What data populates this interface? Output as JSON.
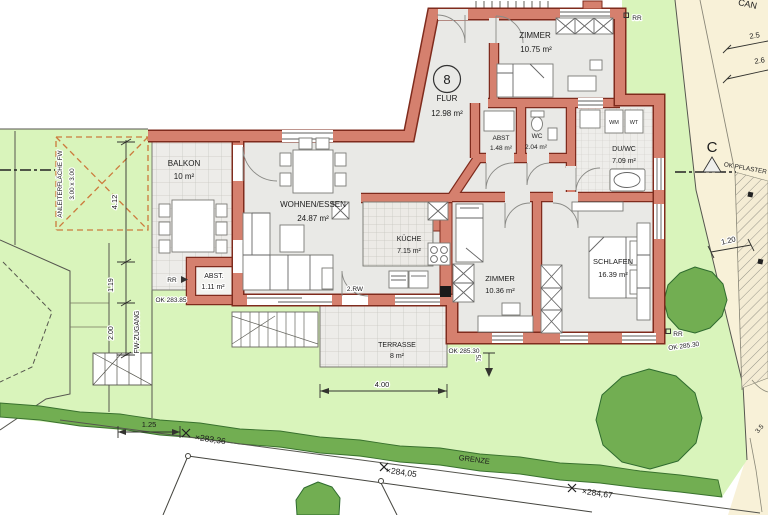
{
  "plan": {
    "apartment_number": "8",
    "rooms": {
      "balkon": {
        "name": "BALKON",
        "area": "10 m²"
      },
      "wohnen": {
        "name": "WOHNEN/ESSEN",
        "area": "24.87 m²"
      },
      "flur": {
        "name": "FLUR",
        "area": "12.98 m²"
      },
      "zimmer1": {
        "name": "ZIMMER",
        "area": "10.75 m²"
      },
      "abst1": {
        "name": "ABST.",
        "area": "1.11 m²"
      },
      "abst2": {
        "name": "ABST",
        "area": "1.48 m²"
      },
      "wc": {
        "name": "WC",
        "area": "2.04 m²"
      },
      "duwc": {
        "name": "DU/WC",
        "area": "7.09 m²"
      },
      "kueche": {
        "name": "KÜCHE",
        "area": "7.15 m²"
      },
      "zimmer2": {
        "name": "ZIMMER",
        "area": "10.36 m²"
      },
      "schlafen": {
        "name": "SCHLAFEN",
        "area": "16.39 m²"
      },
      "terrasse": {
        "name": "TERRASSE",
        "area": "8 m²"
      }
    },
    "appliances": {
      "wm": "WM",
      "wt": "WT"
    },
    "annotations": {
      "rw_door": "2.RW",
      "rr": "RR",
      "ok_283_85": "OK 283.85",
      "ok_285_30": "OK 285.30",
      "grenze": "GRENZE",
      "ok_pflaster": "OK PFLASTER",
      "section_c": "C",
      "street_partial": "CAN",
      "fw_zugang": "FW-ZUGANG",
      "anleiter_line1": "ANLEITERFLÄCHE FW",
      "anleiter_line2": "3.00 x 3.00"
    },
    "dimensions": {
      "d412": "4.12",
      "d119": "1.19",
      "d200": "2.00",
      "d125": "1.25",
      "d400": "4.00",
      "d120": "1.20",
      "d25": "2.5",
      "d26": "2.6",
      "d75": "75",
      "d35": "3.5"
    },
    "elevations": {
      "p1": "×283,36",
      "p2": "×284,05",
      "p3": "×284,67"
    },
    "colors": {
      "wall_fill": "#d5806e",
      "wall_outline": "#7f2b1d",
      "lawn": "#d9f4bb",
      "hedge": "#72ae52",
      "parcel_beige": "#f8f1d8",
      "floor_gray": "#e9e9e6"
    }
  }
}
